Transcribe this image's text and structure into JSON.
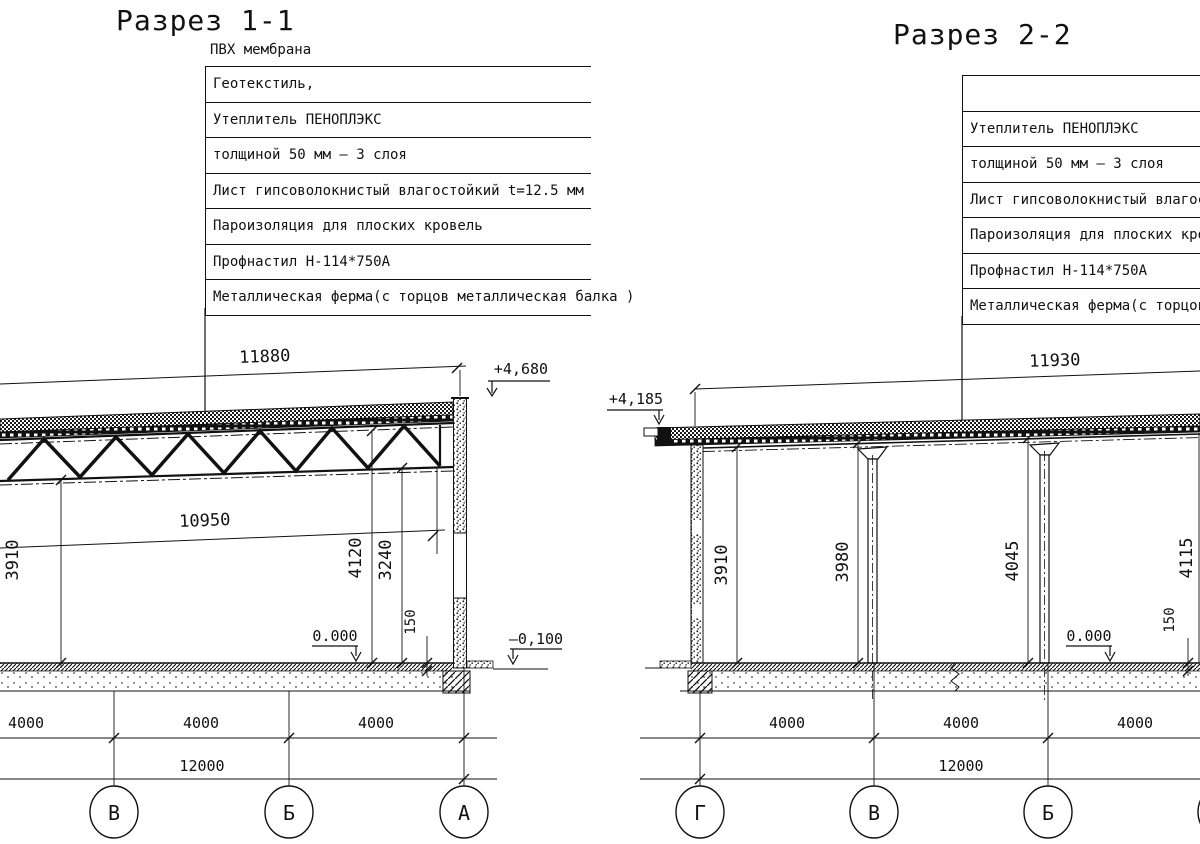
{
  "drawing": {
    "section1": {
      "title": "Разрез 1-1",
      "callout_top": "ПВХ мембрана",
      "callouts": [
        "Геотекстиль,",
        "Утеплитель ПЕНОПЛЭКС",
        "толщиной 50 мм – 3 слоя",
        "Лист гипсоволокнистый влагостойкий t=12.5 мм",
        "Пароизоляция для плоских кровель",
        "Профнастил Н-114*750А",
        "Металлическая ферма(с торцов металлическая балка )"
      ],
      "dims": {
        "roof_span": "11880",
        "truss_span": "10950",
        "h_left": "3910",
        "h_mid": "4120",
        "h_low": "3240",
        "floor": "150",
        "spacing": [
          "4000",
          "4000",
          "4000"
        ],
        "total": "12000"
      },
      "levels": {
        "roof": "+4,680",
        "zero": "0.000",
        "ground": "–0,100"
      },
      "axes": [
        "В",
        "Б",
        "А"
      ]
    },
    "section2": {
      "title": "Разрез 2-2",
      "callouts": [
        "",
        "Утеплитель ПЕНОПЛЭКС",
        "толщиной 50 мм – 3 слоя",
        "Лист гипсоволокнистый влагостойкий t=12.5 мм",
        "Пароизоляция для плоских кровель",
        "Профнастил Н-114*750А",
        "Металлическая ферма(с торцов металлическая балка )"
      ],
      "dims": {
        "roof_span": "11930",
        "h1": "3910",
        "h2": "3980",
        "h3": "4045",
        "h4": "4115",
        "floor": "150",
        "spacing": [
          "4000",
          "4000",
          "4000"
        ],
        "total": "12000"
      },
      "levels": {
        "roof": "+4,185",
        "zero": "0.000"
      },
      "axes": [
        "Г",
        "В",
        "Б",
        "А"
      ]
    }
  }
}
